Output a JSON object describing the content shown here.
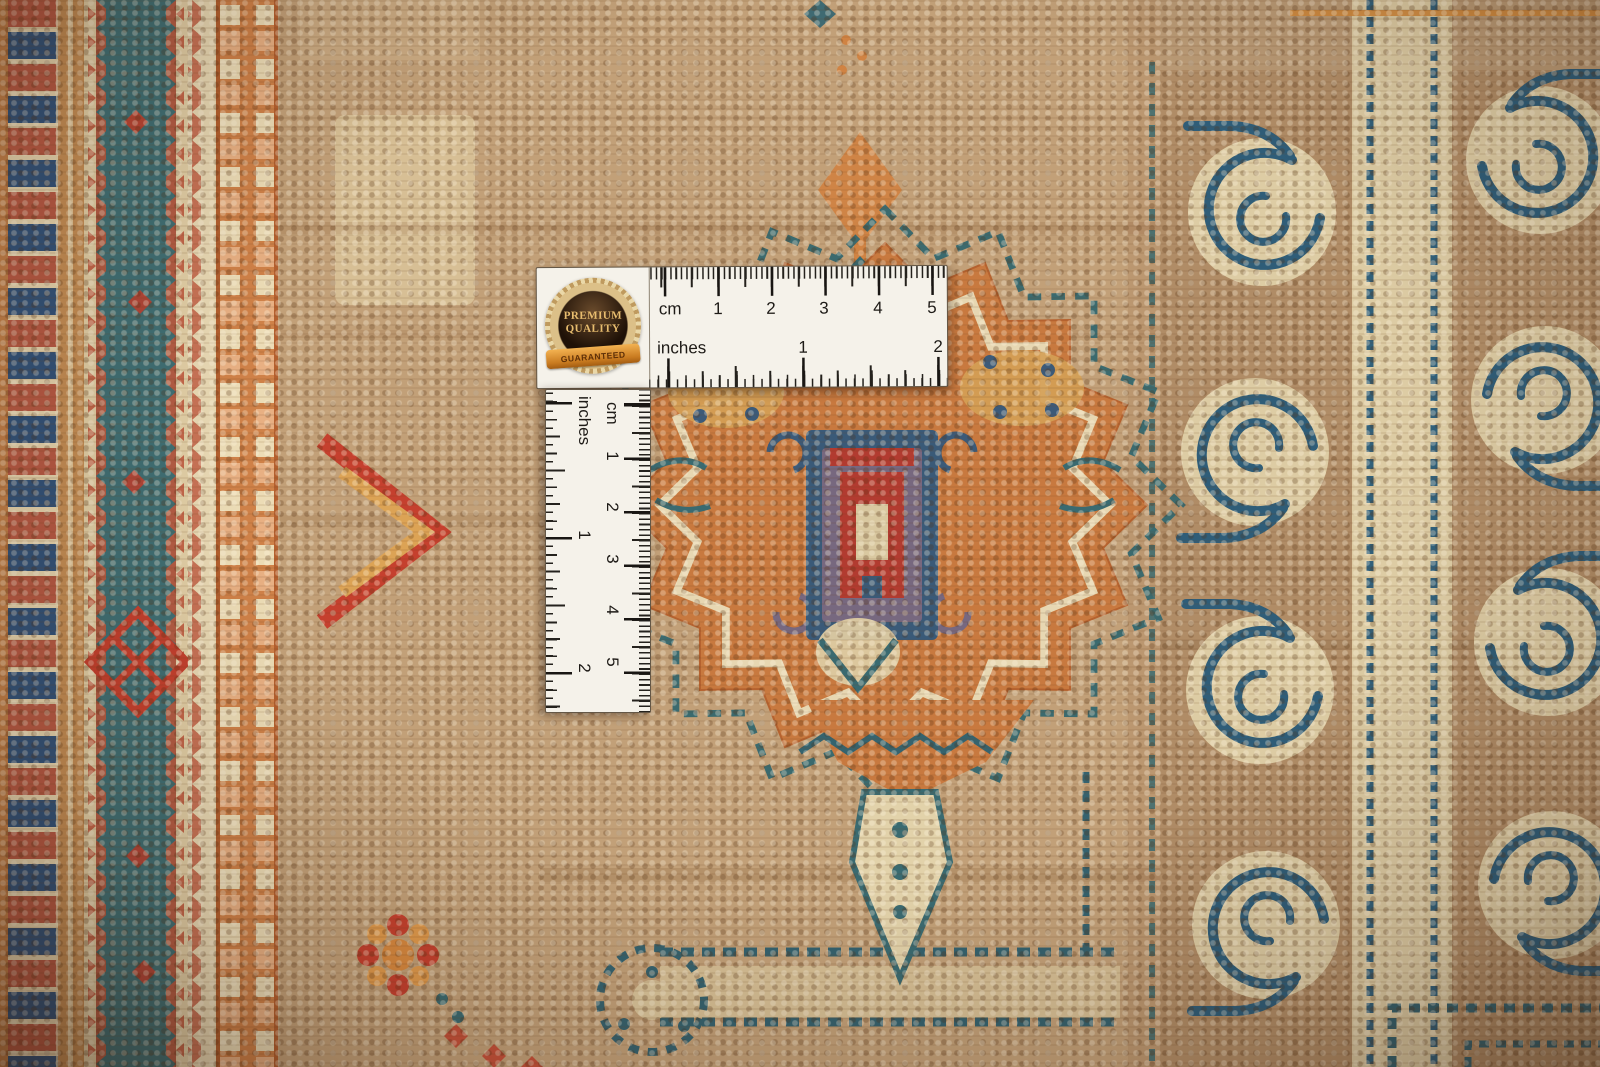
{
  "scene": {
    "type": "product-photo",
    "description": "Macro photograph of a hand-knotted oriental wool rug — beige-tan field, rust-orange serrated star medallion with indigo center box, red-and-navy striped left border with teal zigzag band, indigo scroll (running-hook) border on cream at right — with a white L-shaped measuring ruler and a Premium Quality seal laid on the pile",
    "objects": [
      "carpet",
      "horizontal-ruler",
      "vertical-ruler",
      "quality-badge"
    ]
  },
  "badge": {
    "line1": "PREMIUM",
    "line2": "QUALITY",
    "ribbon": "GUARANTEED"
  },
  "ruler_h": {
    "unit_cm": "cm",
    "cm": [
      "1",
      "2",
      "3",
      "4",
      "5"
    ],
    "unit_in": "inches",
    "in": [
      "1",
      "2"
    ]
  },
  "ruler_v": {
    "unit_cm": "cm",
    "cm": [
      "1",
      "2",
      "3",
      "4",
      "5"
    ],
    "unit_in": "inches",
    "in": [
      "1",
      "2"
    ]
  },
  "palette": {
    "field_tan": "#c2a078",
    "rust_orange": "#c8793f",
    "teal": "#3c6b70",
    "indigo_scroll": "#2f5d78",
    "cream": "#e2d2aa",
    "red": "#c5402e",
    "brick_center": "#b23b30",
    "gold": "#d4a055",
    "right_brown": "#b08c66",
    "navy_block": "#32537a",
    "ruler_white": "#f5f2ea"
  }
}
